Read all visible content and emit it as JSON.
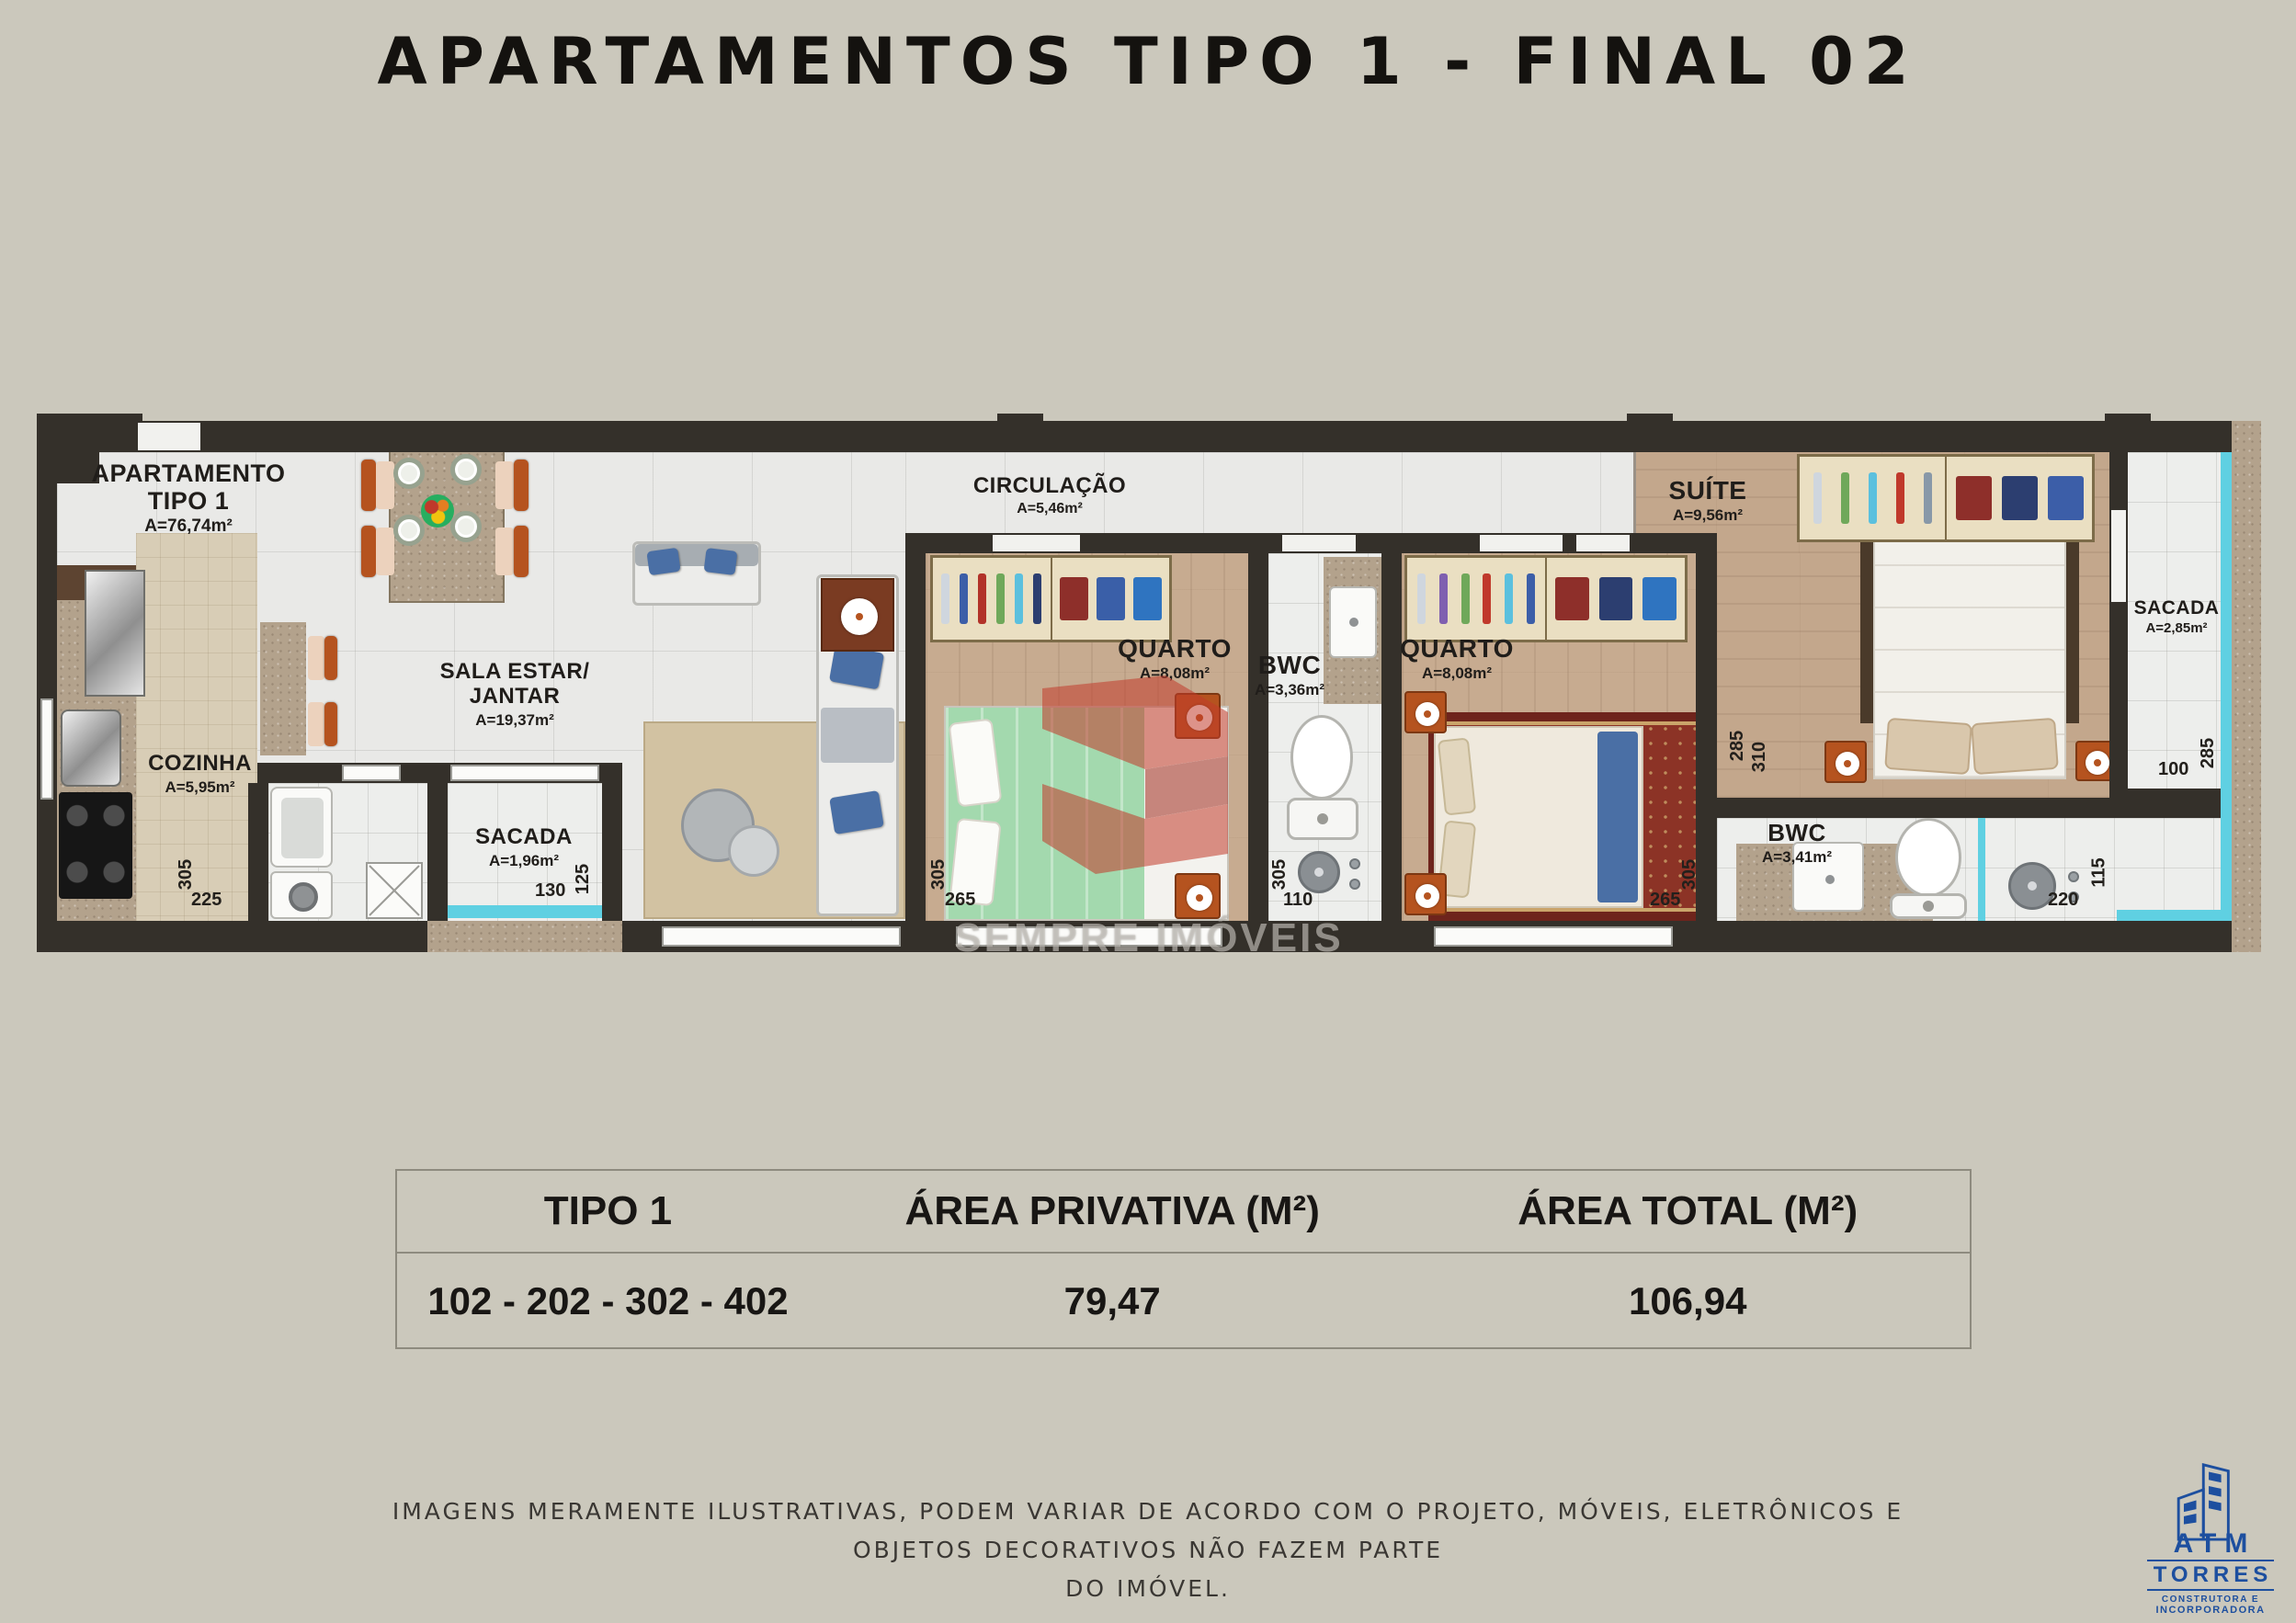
{
  "page": {
    "title": "APARTAMENTOS TIPO 1 - FINAL 02",
    "background": "#cbc8bc"
  },
  "plan": {
    "apartment": {
      "name1": "APARTAMENTO",
      "name2": "TIPO 1",
      "area": "A=76,74m²"
    },
    "rooms": {
      "cozinha": {
        "name": "COZINHA",
        "area": "A=5,95m²",
        "dim_v": "305",
        "dim_h": "225"
      },
      "sala": {
        "name1": "SALA ESTAR/",
        "name2": "JANTAR",
        "area": "A=19,37m²"
      },
      "sacada": {
        "name": "SACADA",
        "area": "A=1,96m²",
        "dim_h": "130",
        "dim_v": "125"
      },
      "circulacao": {
        "name": "CIRCULAÇÃO",
        "area": "A=5,46m²"
      },
      "quarto1": {
        "name": "QUARTO",
        "area": "A=8,08m²",
        "dim_v": "305",
        "dim_h": "265"
      },
      "bwc1": {
        "name": "BWC",
        "area": "A=3,36m²",
        "dim_v": "305",
        "dim_h": "110"
      },
      "quarto2": {
        "name": "QUARTO",
        "area": "A=8,08m²",
        "dim_v": "305",
        "dim_h": "265"
      },
      "suite": {
        "name": "SUÍTE",
        "area": "A=9,56m²",
        "dim_v1": "285",
        "dim_v2": "310"
      },
      "bwc2": {
        "name": "BWC",
        "area": "A=3,41m²",
        "dim_v": "115",
        "dim_h": "220"
      },
      "sacada2": {
        "name": "SACADA",
        "area": "A=2,85m²",
        "dim_h": "100",
        "dim_v": "285"
      }
    },
    "watermark_text": "SEMPRE IMÓVEIS"
  },
  "table": {
    "headers": {
      "tipo": "TIPO 1",
      "privativa": "ÁREA PRIVATIVA (M²)",
      "total": "ÁREA TOTAL (M²)"
    },
    "row": {
      "units": "102 - 202 - 302 - 402",
      "privativa": "79,47",
      "total": "106,94"
    }
  },
  "disclaimer": {
    "line1": "IMAGENS MERAMENTE ILUSTRATIVAS, PODEM VARIAR DE ACORDO COM O PROJETO, MÓVEIS, ELETRÔNICOS E",
    "line2": "OBJETOS DECORATIVOS NÃO FAZEM PARTE",
    "line3": "DO IMÓVEL."
  },
  "logo": {
    "name": "ATM",
    "line2": "TORRES",
    "line3": "CONSTRUTORA E",
    "line4": "INCORPORADORA"
  },
  "colors": {
    "wall": "#34302a",
    "wood_floor": "#c7ab90",
    "tile_floor": "#e9e9e7",
    "glass_cyan": "#5fd0e2",
    "furniture_orange": "#b5531f",
    "watermark_red": "#c23b2b",
    "logo_blue": "#1d4f9f",
    "bed_green": "#a3d9ae",
    "rug_red": "#7e2a20"
  }
}
